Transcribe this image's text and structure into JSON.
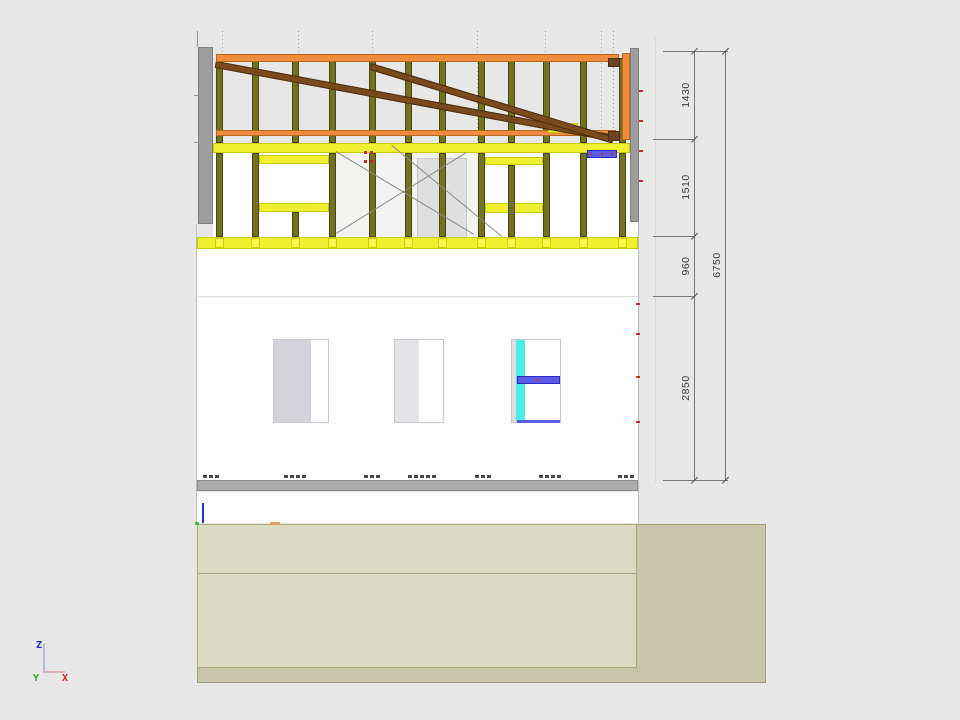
{
  "view": {
    "type": "cad-elevation-drawing",
    "background": "#E7E7E7"
  },
  "dimensions": {
    "chain": [
      {
        "label": "1430"
      },
      {
        "label": "1510"
      },
      {
        "label": "960"
      },
      {
        "label": "2850"
      }
    ],
    "overall": {
      "label": "6750"
    }
  },
  "axis_gizmo": {
    "z_label": "Z",
    "y_label": "Y",
    "x_label": "X"
  },
  "colors": {
    "stud_olive": "#73731F",
    "stud_border": "#474712",
    "plate_orange": "#F08C3C",
    "orange_border": "#B5681C",
    "brace_brown": "#7A4A1C",
    "brown_border": "#4E2E10",
    "band_yellow": "#F0F030",
    "yellow_border": "#C9C900",
    "wall_gray": "#9D9D9D",
    "slab_gray": "#ABABAB",
    "glass_cyan": "#4AEDE9",
    "lintel_blue": "#5B5BE6",
    "terrain_dark": "#C7C6AA",
    "terrain_light": "#DBDAC3",
    "dim_line": "#777777",
    "marker_red": "#C03030"
  },
  "drawing": {
    "shapes": [
      {
        "n": "sheet-lower-wall",
        "x": 197,
        "y": 249,
        "w": 441,
        "h": 231,
        "f": "#FDFDFD"
      },
      {
        "n": "sheet-below-slab",
        "x": 197,
        "y": 492,
        "w": 441,
        "h": 31,
        "f": "#FDFDFD"
      },
      {
        "n": "sheet-upper-wall-band",
        "x": 213,
        "y": 153,
        "w": 425,
        "h": 84,
        "f": "#FDFDFD"
      },
      {
        "n": "xbrace-bay-tint",
        "x": 336,
        "y": 153,
        "w": 142,
        "h": 84,
        "f": "#F2F2F0"
      },
      {
        "n": "ceiling-line",
        "x": 197,
        "y": 296,
        "w": 441,
        "h": 1,
        "f": "#DADADA"
      },
      {
        "n": "sheet-left-edge",
        "x": 196,
        "y": 224,
        "w": 1,
        "h": 300,
        "f": "#BCBCBC"
      },
      {
        "n": "sheet-right-edge",
        "x": 638,
        "y": 48,
        "w": 1,
        "h": 475,
        "f": "#BCBCBC"
      },
      {
        "n": "floor-slab-band",
        "x": 197,
        "y": 480,
        "w": 441,
        "h": 11,
        "f": "#ABABAB",
        "b": "#8E8E8E"
      },
      {
        "n": "clipped-dim-digits",
        "xs": [
          203,
          209,
          215,
          284,
          290,
          296,
          302,
          364,
          370,
          376,
          408,
          414,
          420,
          426,
          432,
          475,
          481,
          487,
          539,
          545,
          551,
          557,
          618,
          624,
          630
        ],
        "y": 475,
        "w": 4,
        "h": 3,
        "f": "#4A4A4A"
      },
      {
        "n": "window-frame",
        "x": 273,
        "y": 339,
        "w": 56,
        "h": 84,
        "f": "#FFFFFF",
        "b": "#C9C9C9"
      },
      {
        "n": "window-leaf-gray",
        "x": 274,
        "y": 340,
        "w": 37,
        "h": 82,
        "f": "#D3D3D9"
      },
      {
        "n": "window-frame",
        "x": 394,
        "y": 339,
        "w": 50,
        "h": 84,
        "f": "#FFFFFF",
        "b": "#C9C9C9"
      },
      {
        "n": "window-leaf-gray",
        "x": 395,
        "y": 340,
        "w": 24,
        "h": 82,
        "f": "#E4E4E8"
      },
      {
        "n": "window-frame",
        "x": 511,
        "y": 339,
        "w": 50,
        "h": 84,
        "f": "#FFFFFF",
        "b": "#C6C6C6"
      },
      {
        "n": "window-jamb-gray",
        "x": 512,
        "y": 340,
        "w": 5,
        "h": 82,
        "f": "#DFDFDF"
      },
      {
        "n": "window-glass-cyan",
        "x": 516,
        "y": 340,
        "w": 9,
        "h": 82,
        "f": "#4AEDE9"
      },
      {
        "n": "window-transom-blue",
        "x": 517,
        "y": 376,
        "w": 43,
        "h": 8,
        "f": "#5B5BE6",
        "b": "#2B2BC4"
      },
      {
        "n": "transom-red-dot",
        "x": 537,
        "y": 379,
        "w": 2,
        "h": 2,
        "f": "#C03030"
      },
      {
        "n": "window-sill-blue",
        "x": 517,
        "y": 420,
        "w": 43,
        "h": 3,
        "f": "#5B5BE6"
      },
      {
        "n": "left-wall-section",
        "x": 198,
        "y": 47,
        "w": 15,
        "h": 177,
        "f": "#9D9D9D",
        "b": "#7E7E7E"
      },
      {
        "n": "right-wall-section",
        "x": 630,
        "y": 48,
        "w": 9,
        "h": 174,
        "f": "#9D9D9D",
        "b": "#7E7E7E"
      },
      {
        "n": "edge-red-marker",
        "xs": [
          639
        ],
        "y": 90,
        "w": 4,
        "h": 2,
        "f": "#C03030"
      },
      {
        "n": "edge-red-marker",
        "xs": [
          639
        ],
        "y": 120,
        "w": 4,
        "h": 2,
        "f": "#C03030"
      },
      {
        "n": "edge-red-marker",
        "xs": [
          639
        ],
        "y": 150,
        "w": 4,
        "h": 2,
        "f": "#C03030"
      },
      {
        "n": "edge-red-marker",
        "xs": [
          639
        ],
        "y": 180,
        "w": 4,
        "h": 2,
        "f": "#C03030"
      },
      {
        "n": "edge-red-marker",
        "xs": [
          636
        ],
        "y": 303,
        "w": 4,
        "h": 2,
        "f": "#C03030"
      },
      {
        "n": "edge-red-marker",
        "xs": [
          636
        ],
        "y": 333,
        "w": 4,
        "h": 2,
        "f": "#C03030"
      },
      {
        "n": "edge-red-marker",
        "xs": [
          636
        ],
        "y": 376,
        "w": 4,
        "h": 2,
        "f": "#C03030"
      },
      {
        "n": "edge-red-marker",
        "xs": [
          636
        ],
        "y": 421,
        "w": 4,
        "h": 2,
        "f": "#C03030"
      },
      {
        "n": "viewport-line",
        "x": 655,
        "y": 37,
        "w": 1,
        "h": 445,
        "f": "#D8D8D8"
      },
      {
        "n": "corner-tick",
        "x": 197,
        "y": 31,
        "w": 1,
        "h": 16,
        "f": "#979797"
      },
      {
        "n": "left-tick",
        "x": 194,
        "y": 95,
        "w": 5,
        "h": 1,
        "f": "#979797"
      },
      {
        "n": "left-tick",
        "x": 194,
        "y": 142,
        "w": 5,
        "h": 1,
        "f": "#979797"
      },
      {
        "n": "grid-line-dotted",
        "xs": [
          222,
          298,
          372,
          477,
          545,
          601,
          613
        ],
        "y": 31,
        "w": 1,
        "h": 112,
        "dash": true
      },
      {
        "n": "attic-stud",
        "xs": [
          216,
          252,
          292,
          329,
          369,
          405,
          439,
          478,
          508,
          543,
          580,
          619
        ],
        "y": 58,
        "w": 7,
        "h": 85,
        "f": "#73731F",
        "b": "#474712"
      },
      {
        "n": "mid-rail-orange",
        "x": 216,
        "y": 130,
        "w": 400,
        "h": 6,
        "f": "#F08C3C",
        "b": "#B5681C"
      },
      {
        "n": "brace-block-yellow",
        "x": 548,
        "y": 123,
        "w": 30,
        "h": 10,
        "f": "#F0F030",
        "b": "#C9C900"
      },
      {
        "n": "roof-brace",
        "x": 216,
        "y": 61,
        "w": 405,
        "h": 7,
        "f": "#7A4A1C",
        "b": "#4E2E10",
        "r": 10.5
      },
      {
        "n": "roof-brace",
        "x": 371,
        "y": 63,
        "w": 254,
        "h": 7,
        "f": "#7A4A1C",
        "b": "#4E2E10",
        "r": 16.9
      },
      {
        "n": "top-plate-orange",
        "x": 216,
        "y": 54,
        "w": 403,
        "h": 8,
        "f": "#F08C3C",
        "b": "#B5681C"
      },
      {
        "n": "brace-anchor-brown",
        "x": 608,
        "y": 58,
        "w": 12,
        "h": 9,
        "f": "#6B4423",
        "b": "#4E2E10"
      },
      {
        "n": "brace-anchor-brown",
        "x": 608,
        "y": 131,
        "w": 12,
        "h": 10,
        "f": "#6B4423",
        "b": "#4E2E10"
      },
      {
        "n": "end-post-orange",
        "x": 622,
        "y": 53,
        "w": 8,
        "h": 87,
        "f": "#F08C3C",
        "b": "#B5681C"
      },
      {
        "n": "top-band-yellow",
        "x": 213,
        "y": 143,
        "w": 417,
        "h": 10,
        "f": "#F0F030",
        "b": "#C9C900"
      },
      {
        "n": "door-panel",
        "x": 417,
        "y": 158,
        "w": 50,
        "h": 80,
        "f": "#DFDFDF",
        "b": "#C8C8C8"
      },
      {
        "n": "window-header-yellow",
        "x": 259,
        "y": 155,
        "w": 70,
        "h": 9,
        "f": "#F0F030",
        "b": "#C9C900"
      },
      {
        "n": "window-sill-yellow",
        "x": 259,
        "y": 203,
        "w": 70,
        "h": 9,
        "f": "#F0F030",
        "b": "#C9C900"
      },
      {
        "n": "window-header-yellow",
        "x": 485,
        "y": 157,
        "w": 58,
        "h": 8,
        "f": "#F0F030",
        "b": "#C9C900"
      },
      {
        "n": "window-sill-yellow",
        "x": 485,
        "y": 203,
        "w": 58,
        "h": 10,
        "f": "#F0F030",
        "b": "#C9C900"
      },
      {
        "n": "wall-stud",
        "xs": [
          216,
          252,
          329,
          369,
          405,
          439,
          478,
          543,
          580,
          619
        ],
        "y": 153,
        "w": 7,
        "h": 84,
        "f": "#73731F",
        "b": "#474712"
      },
      {
        "n": "cripple-stud",
        "x": 292,
        "y": 212,
        "w": 7,
        "h": 25,
        "f": "#73731F",
        "b": "#474712"
      },
      {
        "n": "window-mid-stud",
        "x": 508,
        "y": 165,
        "w": 7,
        "h": 72,
        "f": "#73731F",
        "b": "#474712"
      },
      {
        "n": "xbrace-line",
        "x": 336,
        "y": 151,
        "w": 161,
        "h": 1,
        "f": "#8A8A8A",
        "r": 31.0
      },
      {
        "n": "xbrace-line",
        "x": 336,
        "y": 233,
        "w": 153,
        "h": 1,
        "f": "#8A8A8A",
        "r": -31.9
      },
      {
        "n": "xbrace-line",
        "x": 392,
        "y": 145,
        "w": 143,
        "h": 1,
        "f": "#8A8A8A",
        "r": 39.6
      },
      {
        "n": "stud-red-marker",
        "xs": [
          364,
          370
        ],
        "y": 151,
        "w": 3,
        "h": 3,
        "f": "#CC2222"
      },
      {
        "n": "stud-red-marker",
        "xs": [
          364,
          370
        ],
        "y": 160,
        "w": 3,
        "h": 3,
        "f": "#CC2222"
      },
      {
        "n": "steel-lintel-blue",
        "x": 587,
        "y": 150,
        "w": 30,
        "h": 8,
        "f": "#5B5BE6",
        "b": "#2B2BC4"
      },
      {
        "n": "lintel-red-dot",
        "xs": [
          590,
          601,
          611
        ],
        "y": 153,
        "w": 2,
        "h": 2,
        "f": "#CC2222"
      },
      {
        "n": "floor-band-yellow",
        "x": 197,
        "y": 237,
        "w": 441,
        "h": 12,
        "f": "#F0F030",
        "b": "#C9C900"
      },
      {
        "n": "stud-cap-yellow",
        "xs": [
          215,
          251,
          291,
          328,
          368,
          404,
          438,
          477,
          507,
          542,
          579,
          618
        ],
        "y": 238,
        "w": 9,
        "h": 10,
        "f": "#F8F84F",
        "b": "#D0D000"
      },
      {
        "n": "terrain-block",
        "x": 197,
        "y": 524,
        "w": 569,
        "h": 159,
        "f": "#C7C6AA",
        "b": "#9FA172"
      },
      {
        "n": "terrain-section-light",
        "x": 197,
        "y": 524,
        "w": 440,
        "h": 144,
        "f": "#DBDAC3",
        "b": "#A8A97D"
      },
      {
        "n": "terrain-layer-line",
        "x": 197,
        "y": 573,
        "w": 440,
        "h": 1,
        "f": "#A8A97D"
      },
      {
        "n": "level-tick-blue",
        "x": 202,
        "y": 503,
        "w": 2,
        "h": 20,
        "f": "#2233CC"
      },
      {
        "n": "level-dot-green",
        "x": 195,
        "y": 522,
        "w": 4,
        "h": 3,
        "f": "#44BB44"
      },
      {
        "n": "level-dash-orange",
        "x": 270,
        "y": 522,
        "w": 10,
        "h": 3,
        "f": "#E8A060"
      },
      {
        "n": "dim-ext-line",
        "x": 663,
        "y": 51,
        "w": 65,
        "h": 1,
        "f": "#777777"
      },
      {
        "n": "dim-ext-line",
        "x": 653,
        "y": 139,
        "w": 42,
        "h": 1,
        "f": "#777777"
      },
      {
        "n": "dim-ext-line",
        "x": 653,
        "y": 236,
        "w": 42,
        "h": 1,
        "f": "#777777"
      },
      {
        "n": "dim-ext-line",
        "x": 653,
        "y": 296,
        "w": 42,
        "h": 1,
        "f": "#777777"
      },
      {
        "n": "dim-ext-line",
        "x": 663,
        "y": 480,
        "w": 65,
        "h": 1,
        "f": "#777777"
      },
      {
        "n": "dim-chain-line",
        "x": 694,
        "y": 51,
        "w": 1,
        "h": 429,
        "f": "#777777"
      },
      {
        "n": "dim-overall-line",
        "x": 725,
        "y": 51,
        "w": 1,
        "h": 429,
        "f": "#777777"
      },
      {
        "n": "dim-tick",
        "xs": [
          691,
          722
        ],
        "y": 54,
        "w": 9,
        "h": 1,
        "f": "#555555",
        "r": -45
      },
      {
        "n": "dim-tick",
        "xs": [
          691
        ],
        "y": 142,
        "w": 9,
        "h": 1,
        "f": "#555555",
        "r": -45
      },
      {
        "n": "dim-tick",
        "xs": [
          691
        ],
        "y": 239,
        "w": 9,
        "h": 1,
        "f": "#555555",
        "r": -45
      },
      {
        "n": "dim-tick",
        "xs": [
          691
        ],
        "y": 299,
        "w": 9,
        "h": 1,
        "f": "#555555",
        "r": -45
      },
      {
        "n": "dim-tick",
        "xs": [
          691,
          722
        ],
        "y": 483,
        "w": 9,
        "h": 1,
        "f": "#555555",
        "r": -45
      },
      {
        "n": "axis-z-line",
        "x": 43,
        "y": 644,
        "w": 2,
        "h": 29,
        "f": "#B4BCD8"
      },
      {
        "n": "axis-x-line",
        "x": 43,
        "y": 671,
        "w": 22,
        "h": 2,
        "f": "#D8B4B4"
      }
    ]
  }
}
